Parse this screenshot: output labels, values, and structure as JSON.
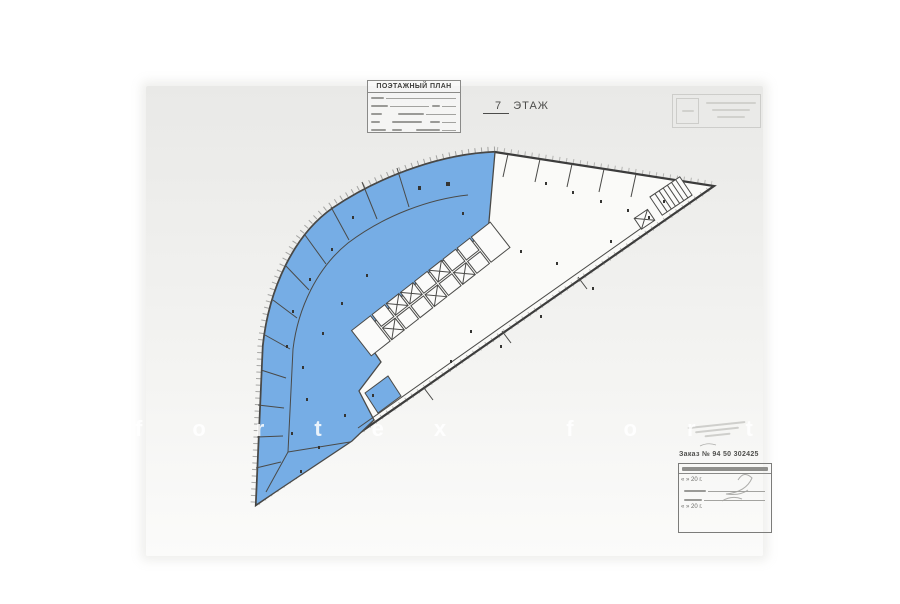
{
  "scan": {
    "floor_plan_title": "ПОЭТАЖНЫЙ ПЛАН",
    "floor_number": "7",
    "floor_word": "ЭТАЖ",
    "order_number_line": "Заказ № 94 50 302425",
    "order_box": {
      "date_row_1": "«    »              20    г.",
      "date_row_2": "«    »              20    г."
    },
    "watermark_text": "fortex fortex",
    "colors": {
      "highlight_blue": "#76ade5",
      "paper": "#efefed",
      "ink": "#3c3c3c"
    }
  }
}
